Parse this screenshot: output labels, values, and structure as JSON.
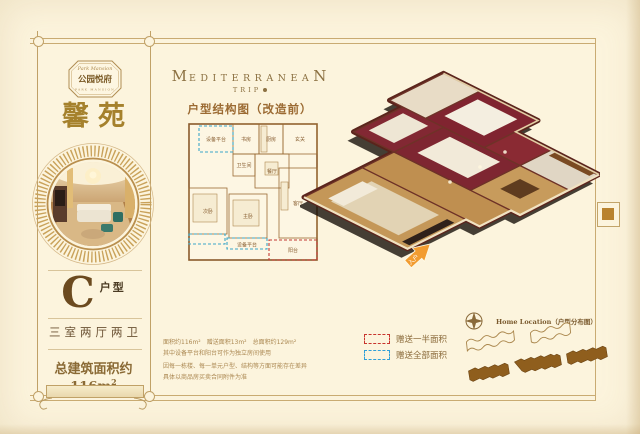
{
  "page": {
    "background": "#fcf4dd",
    "frame_color": "#c9ab72",
    "accent_gold": "#b98f4e"
  },
  "left_panel": {
    "badge_script": "Park Mansion",
    "badge_name": "公园悦府",
    "badge_sub": "PARK MANSION",
    "project_name": "馨苑",
    "unit_letter": "C",
    "unit_suffix": "户型",
    "rooms_desc": "三室两厅两卫",
    "area_main": "总建筑面积约116m",
    "area_sup": "2"
  },
  "header": {
    "title_first": "M",
    "title_mid": "EDITERRANEA",
    "title_last": "N",
    "subtitle": "TRIP",
    "plan_title": "户型结构图（改造前）"
  },
  "floorplan": {
    "labels": {
      "equip_top": "设备平台",
      "study": "书房",
      "kitchen": "厨房",
      "entry": "玄关",
      "bath": "卫生间",
      "dining": "餐厅",
      "bed2": "次卧",
      "bed1": "主卧",
      "living": "客厅",
      "equip_bottom": "设备平台",
      "balcony": "阳台"
    }
  },
  "notes": {
    "line1": "面积约116m²　赠送面积13m²　总面积约129m²",
    "line2": "其中设备平台和阳台可作为独立房间使用",
    "line3": "因每一栋楼、每一单元户型、结构等方面可能存在差异",
    "line4": "具体以商品房买卖合同附件为准"
  },
  "legend": {
    "half": {
      "label": "赠送一半面积",
      "color": "#c8342d"
    },
    "full": {
      "label": "赠送全部面积",
      "color": "#2f9fd8"
    }
  },
  "render3d": {
    "entry_label": "入户",
    "arrow_color": "#f29c30"
  },
  "location_map": {
    "title": "Home Location（户型分布图）"
  }
}
